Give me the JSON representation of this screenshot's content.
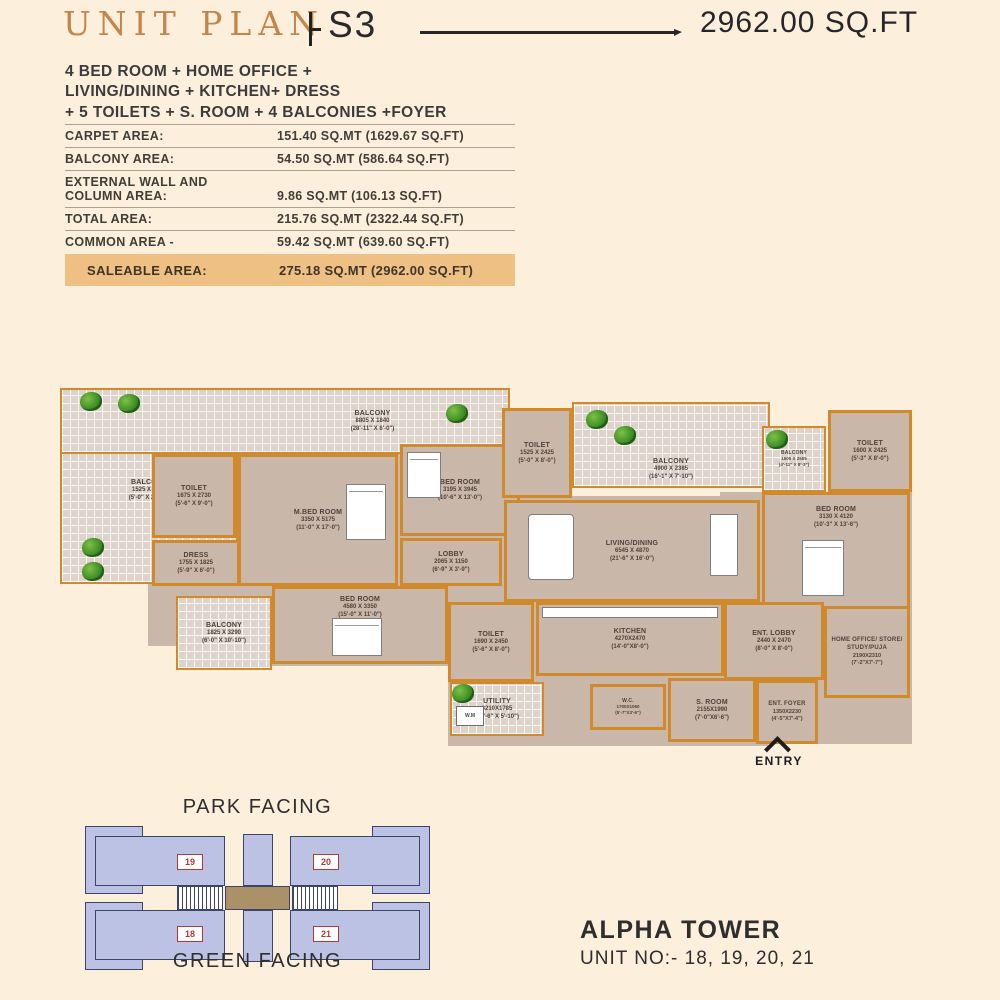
{
  "header": {
    "title": "UNIT PLAN",
    "unit_code": "S3",
    "area": "2962.00 SQ.FT"
  },
  "description": [
    "4 BED ROOM + HOME OFFICE +",
    "LIVING/DINING + KITCHEN+ DRESS",
    "+ 5 TOILETS + S. ROOM + 4 BALCONIES +FOYER"
  ],
  "area_table": {
    "rows": [
      {
        "label": "CARPET AREA:",
        "value": "151.40 SQ.MT (1629.67 SQ.FT)"
      },
      {
        "label": "BALCONY AREA:",
        "value": "54.50 SQ.MT (586.64 SQ.FT)"
      },
      {
        "label": "EXTERNAL WALL AND\nCOLUMN AREA:",
        "value": "9.86 SQ.MT (106.13 SQ.FT)"
      },
      {
        "label": "TOTAL AREA:",
        "value": "215.76 SQ.MT (2322.44 SQ.FT)"
      },
      {
        "label": "COMMON AREA -",
        "value": "59.42 SQ.MT (639.60 SQ.FT)"
      }
    ],
    "saleable": {
      "label": "SALEABLE AREA:",
      "value": "275.18 SQ.MT (2962.00 SQ.FT)"
    }
  },
  "floor_plan": {
    "rooms": [
      {
        "name": "BALCONY",
        "mm": "8805 X 1840",
        "ft": "(28'-11\" X 6'-0\")"
      },
      {
        "name": "BALCONY",
        "mm": "1525 X 7340",
        "ft": "(5'-0\" X 24'-1\")"
      },
      {
        "name": "TOILET",
        "mm": "1675 X 2730",
        "ft": "(5'-6\" X 9'-0\")"
      },
      {
        "name": "DRESS",
        "mm": "1755 X 1825",
        "ft": "(5'-9\" X 6'-0\")"
      },
      {
        "name": "M.BED ROOM",
        "mm": "3350 X 5175",
        "ft": "(11'-0\" X 17'-0\")"
      },
      {
        "name": "BED ROOM",
        "mm": "3195 X 3945",
        "ft": "(10'-6\" X 13'-0\")"
      },
      {
        "name": "TOILET",
        "mm": "1525 X 2425",
        "ft": "(5'-0\" X 8'-0\")"
      },
      {
        "name": "BALCONY",
        "mm": "4900 X 2385",
        "ft": "(16'-1\" X 7'-10\")"
      },
      {
        "name": "LOBBY",
        "mm": "2065 X 1150",
        "ft": "(6'-9\" X 3'-9\")"
      },
      {
        "name": "LIVING/DINING",
        "mm": "6545 X 4870",
        "ft": "(21'-6\" X 16'-0\")"
      },
      {
        "name": "TOILET",
        "mm": "1600 X 2425",
        "ft": "(5'-3\" X 8'-0\")"
      },
      {
        "name": "BALCONY",
        "mm": "1500 X 2505",
        "ft": "(4'-11\" X 8'-3\")"
      },
      {
        "name": "BED ROOM",
        "mm": "3130 X 4120",
        "ft": "(10'-3\" X 13'-6\")"
      },
      {
        "name": "BED ROOM",
        "mm": "4580 X 3350",
        "ft": "(15'-0\" X 11'-0\")"
      },
      {
        "name": "BALCONY",
        "mm": "1825 X 3290",
        "ft": "(6'-0\" X 10'-10\")"
      },
      {
        "name": "KITCHEN",
        "mm": "4270X2470",
        "ft": "(14'-0\"X8'-0\")"
      },
      {
        "name": "TOILET",
        "mm": "1690 X 2450",
        "ft": "(5'-6\" X 8'-0\")"
      },
      {
        "name": "UTILITY",
        "mm": "3210X1785",
        "ft": "(10'-6\" X 5'-10\")"
      },
      {
        "name": "S. ROOM",
        "mm": "2155X1990",
        "ft": "(7'-0\"X6'-6\")"
      },
      {
        "name": "ENT. LOBBY",
        "mm": "2440 X 2470",
        "ft": "(8'-0\" X 8'-0\")"
      },
      {
        "name": "HOME OFFICE/ STORE/ STUDY/PUJA",
        "mm": "2190X2310",
        "ft": "(7'-2\"X7'-7\")"
      },
      {
        "name": "ENT. FOYER",
        "mm": "1350X2230",
        "ft": "(4'-5\"X7'-4\")"
      },
      {
        "name": "W.C.",
        "mm": "1700X1060",
        "ft": "(5'-7\"X3'-6\")"
      }
    ],
    "wm_label": "W.M",
    "entry_label": "ENTRY"
  },
  "key_plan": {
    "top_label": "PARK FACING",
    "bottom_label": "GREEN FACING",
    "units": [
      "19",
      "20",
      "18",
      "21"
    ]
  },
  "footer": {
    "tower": "ALPHA TOWER",
    "unit_numbers": "UNIT NO:- 18, 19, 20, 21"
  },
  "colors": {
    "background": "#fcefdc",
    "accent_gold": "#c4854a",
    "saleable_highlight": "#eec083",
    "wall": "#d08a2b",
    "floor": "#c9b7a9",
    "keyplan_fill": "#bcc2e4",
    "unit_number_red": "#b03a32"
  }
}
